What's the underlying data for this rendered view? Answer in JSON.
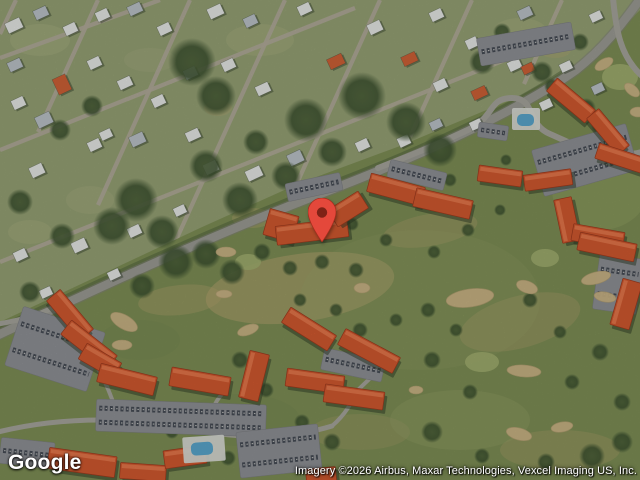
{
  "branding": {
    "logo": "Google"
  },
  "attribution": {
    "text": "Imagery ©2026 Airbus, Maxar Technologies, Vexcel Imaging US, Inc."
  },
  "marker": {
    "x": 322,
    "y": 242,
    "color": "#e4483b",
    "outline": "#a72d1d",
    "dot": "#7e2216"
  },
  "map": {
    "width": 640,
    "height": 480,
    "palette": {
      "golf_base": "#7e8f56",
      "golf_tan": "#b9a771",
      "golf_light": "#99a467",
      "golf_dark": "#6d814b",
      "bunker": "#cdb687",
      "green": "#a3b070",
      "res_base": "#96a275",
      "lawn": "#abb183",
      "street": "#b4ad9c",
      "road": "#9c9c95",
      "lane": "#a7a69d",
      "roof": "#d2592f",
      "roof_hi": "#ec8054",
      "roof_edge": "#9d3a1e",
      "house_w": "#e8eae7",
      "house_g": "#bcc4ca",
      "house_o": "#cf6136",
      "parking": "#8f9196",
      "car_dark": "#3f454e",
      "car_light": "#d8d8d4",
      "pool": "#5aa7cd",
      "deck": "#dadcd6",
      "tree": "#3d5230"
    },
    "residential": {
      "outline": "0,0 640,0 640,10 598,52 520,96 400,146 300,183 200,228 96,277 0,322",
      "patches": [
        [
          40,
          40,
          30,
          16,
          "lawn",
          0.45
        ],
        [
          260,
          40,
          34,
          16,
          "lawn",
          0.4
        ],
        [
          520,
          30,
          26,
          12,
          "lawn",
          0.4
        ],
        [
          90,
          200,
          24,
          14,
          "lawn",
          0.35
        ],
        [
          30,
          232,
          22,
          12,
          "lawn",
          0.4
        ],
        [
          150,
          60,
          26,
          12,
          "lawn",
          0.3
        ],
        [
          252,
          218,
          20,
          10,
          "tan",
          0.35
        ],
        [
          218,
          108,
          14,
          8,
          "tan",
          0.3
        ],
        [
          555,
          50,
          16,
          8,
          "tan",
          0.3
        ]
      ],
      "streets": [
        [
          0,
          58,
          160,
          0
        ],
        [
          0,
          150,
          355,
          8
        ],
        [
          0,
          262,
          540,
          46
        ],
        [
          16,
          0,
          0,
          34
        ],
        [
          98,
          0,
          38,
          132
        ],
        [
          190,
          0,
          98,
          205
        ],
        [
          285,
          0,
          172,
          249
        ],
        [
          380,
          0,
          293,
          192
        ],
        [
          472,
          0,
          410,
          137
        ],
        [
          562,
          0,
          524,
          84
        ]
      ],
      "house_rotation": -25,
      "houses": [
        [
          6,
          20,
          16,
          11,
          "w"
        ],
        [
          34,
          8,
          14,
          10,
          "g"
        ],
        [
          64,
          24,
          13,
          10,
          "w"
        ],
        [
          96,
          10,
          13,
          10,
          "w"
        ],
        [
          128,
          4,
          14,
          10,
          "g"
        ],
        [
          158,
          24,
          13,
          10,
          "w"
        ],
        [
          208,
          6,
          15,
          11,
          "w"
        ],
        [
          244,
          16,
          13,
          10,
          "g"
        ],
        [
          298,
          4,
          13,
          10,
          "w"
        ],
        [
          368,
          22,
          14,
          11,
          "w"
        ],
        [
          430,
          10,
          13,
          10,
          "w"
        ],
        [
          466,
          38,
          12,
          10,
          "w"
        ],
        [
          518,
          8,
          14,
          10,
          "g"
        ],
        [
          554,
          28,
          13,
          10,
          "w"
        ],
        [
          590,
          12,
          12,
          9,
          "w"
        ],
        [
          8,
          60,
          14,
          10,
          "g"
        ],
        [
          55,
          76,
          14,
          17,
          "o"
        ],
        [
          88,
          58,
          13,
          10,
          "w"
        ],
        [
          118,
          78,
          14,
          10,
          "w"
        ],
        [
          152,
          96,
          13,
          10,
          "w"
        ],
        [
          184,
          68,
          13,
          10,
          "g"
        ],
        [
          222,
          60,
          13,
          10,
          "w"
        ],
        [
          256,
          84,
          14,
          10,
          "w"
        ],
        [
          328,
          56,
          16,
          11,
          "o"
        ],
        [
          402,
          54,
          15,
          10,
          "o"
        ],
        [
          434,
          80,
          13,
          10,
          "w"
        ],
        [
          472,
          88,
          15,
          10,
          "o"
        ],
        [
          508,
          60,
          13,
          10,
          "w"
        ],
        [
          522,
          64,
          12,
          9,
          "o"
        ],
        [
          560,
          62,
          12,
          9,
          "w"
        ],
        [
          592,
          84,
          12,
          9,
          "g"
        ],
        [
          12,
          98,
          13,
          10,
          "w"
        ],
        [
          36,
          114,
          16,
          12,
          "g"
        ],
        [
          88,
          140,
          13,
          10,
          "w"
        ],
        [
          130,
          134,
          15,
          11,
          "g"
        ],
        [
          100,
          130,
          12,
          9,
          "w"
        ],
        [
          186,
          130,
          14,
          10,
          "w"
        ],
        [
          204,
          162,
          14,
          11,
          "w"
        ],
        [
          246,
          168,
          16,
          11,
          "w"
        ],
        [
          288,
          152,
          15,
          12,
          "g"
        ],
        [
          320,
          180,
          13,
          10,
          "w"
        ],
        [
          356,
          140,
          13,
          10,
          "w"
        ],
        [
          398,
          136,
          12,
          10,
          "w"
        ],
        [
          430,
          120,
          12,
          9,
          "g"
        ],
        [
          470,
          120,
          12,
          9,
          "w"
        ],
        [
          540,
          100,
          12,
          9,
          "w"
        ],
        [
          30,
          165,
          14,
          11,
          "w"
        ],
        [
          14,
          250,
          13,
          10,
          "w"
        ],
        [
          72,
          240,
          15,
          11,
          "w"
        ],
        [
          128,
          226,
          13,
          10,
          "w"
        ],
        [
          174,
          206,
          12,
          9,
          "w"
        ],
        [
          108,
          270,
          12,
          9,
          "w"
        ],
        [
          40,
          288,
          12,
          9,
          "w"
        ]
      ]
    },
    "golf": {
      "patches": [
        [
          300,
          288,
          95,
          34,
          -8,
          "tan",
          0.5
        ],
        [
          520,
          322,
          62,
          26,
          -15,
          "tan",
          0.3
        ],
        [
          430,
          230,
          48,
          16,
          -10,
          "tan",
          0.3
        ],
        [
          560,
          450,
          60,
          20,
          0,
          "tan",
          0.28
        ],
        [
          360,
          432,
          50,
          18,
          0,
          "tan",
          0.22
        ],
        [
          180,
          300,
          42,
          15,
          -6,
          "tan",
          0.35
        ],
        [
          460,
          420,
          70,
          30,
          0,
          "light",
          0.35
        ],
        [
          600,
          190,
          48,
          40,
          0,
          "light",
          0.4
        ],
        [
          420,
          300,
          120,
          70,
          0,
          "light",
          0.18
        ],
        [
          240,
          420,
          60,
          26,
          0,
          "dark",
          0.15
        ],
        [
          140,
          340,
          40,
          20,
          0,
          "dark",
          0.12
        ]
      ],
      "greens": [
        [
          620,
          77,
          18,
          13
        ],
        [
          482,
          362,
          17,
          10
        ],
        [
          545,
          258,
          14,
          9
        ],
        [
          248,
          262,
          13,
          8
        ]
      ],
      "bunkers": [
        [
          470,
          298,
          24,
          9,
          -8
        ],
        [
          362,
          288,
          8,
          5,
          0
        ],
        [
          527,
          287,
          11,
          6,
          20
        ],
        [
          596,
          278,
          15,
          6,
          -14
        ],
        [
          605,
          297,
          11,
          5,
          10
        ],
        [
          524,
          371,
          17,
          6,
          4
        ],
        [
          562,
          427,
          11,
          5,
          -10
        ],
        [
          519,
          434,
          13,
          6,
          15
        ],
        [
          124,
          322,
          15,
          7,
          30
        ],
        [
          122,
          345,
          10,
          5,
          0
        ],
        [
          248,
          330,
          11,
          5,
          -20
        ],
        [
          226,
          252,
          10,
          5,
          0
        ],
        [
          604,
          64,
          10,
          5,
          -30
        ],
        [
          632,
          90,
          9,
          5,
          40
        ],
        [
          416,
          390,
          7,
          4,
          0
        ],
        [
          638,
          112,
          8,
          5,
          0
        ],
        [
          224,
          294,
          8,
          4,
          0
        ]
      ]
    },
    "tree_line": "M -4,330 C 90,286 200,234 320,188 C 420,151 520,104 574,65",
    "trees": [
      [
        192,
        62,
        24
      ],
      [
        216,
        96,
        20
      ],
      [
        306,
        120,
        22
      ],
      [
        362,
        96,
        24
      ],
      [
        406,
        122,
        20
      ],
      [
        440,
        150,
        17
      ],
      [
        332,
        152,
        15
      ],
      [
        136,
        200,
        22
      ],
      [
        162,
        232,
        17
      ],
      [
        112,
        226,
        19
      ],
      [
        256,
        142,
        13
      ],
      [
        286,
        176,
        15
      ],
      [
        206,
        166,
        17
      ],
      [
        240,
        200,
        18
      ],
      [
        60,
        130,
        11
      ],
      [
        92,
        106,
        11
      ],
      [
        20,
        202,
        13
      ],
      [
        62,
        236,
        13
      ],
      [
        30,
        292,
        11
      ],
      [
        142,
        286,
        13
      ],
      [
        482,
        62,
        13
      ],
      [
        542,
        72,
        11
      ],
      [
        502,
        32,
        9
      ],
      [
        580,
        42,
        9
      ],
      [
        176,
        262,
        18
      ],
      [
        206,
        254,
        15
      ],
      [
        232,
        272,
        13
      ],
      [
        586,
        108,
        10
      ],
      [
        600,
        126,
        9
      ],
      [
        262,
        252,
        9
      ],
      [
        290,
        268,
        8
      ],
      [
        322,
        262,
        8
      ],
      [
        356,
        270,
        8
      ],
      [
        240,
        360,
        9
      ],
      [
        266,
        390,
        8
      ],
      [
        300,
        300,
        7
      ],
      [
        336,
        310,
        7
      ],
      [
        360,
        330,
        8
      ],
      [
        396,
        320,
        7
      ],
      [
        428,
        310,
        8
      ],
      [
        456,
        330,
        7
      ],
      [
        432,
        360,
        9
      ],
      [
        470,
        392,
        8
      ],
      [
        432,
        432,
        11
      ],
      [
        332,
        442,
        9
      ],
      [
        302,
        422,
        8
      ],
      [
        530,
        300,
        8
      ],
      [
        560,
        332,
        7
      ],
      [
        600,
        352,
        9
      ],
      [
        572,
        382,
        8
      ],
      [
        622,
        402,
        9
      ],
      [
        592,
        456,
        13
      ],
      [
        622,
        442,
        11
      ],
      [
        546,
        462,
        9
      ],
      [
        482,
        456,
        8
      ],
      [
        434,
        252,
        7
      ],
      [
        468,
        230,
        7
      ],
      [
        500,
        210,
        6
      ],
      [
        386,
        240,
        7
      ],
      [
        228,
        458,
        8
      ],
      [
        172,
        432,
        7
      ],
      [
        352,
        224,
        7
      ],
      [
        450,
        180,
        7
      ],
      [
        506,
        160,
        6
      ],
      [
        552,
        86,
        8
      ]
    ],
    "roads": [
      {
        "d": "M -4,336 C 90,292 200,240 320,194 C 420,156 520,110 576,70 C 604,48 622,24 638,2",
        "w": 8.5,
        "c": "road",
        "casing": true
      },
      {
        "d": "M 378,168 C 430,148 446,140 468,130 C 496,116 488,98 512,98 C 536,98 526,124 550,134 C 578,146 602,162 642,152",
        "w": 6,
        "c": "lane"
      },
      {
        "d": "M 613,-2 C 616,30 620,56 642,76",
        "w": 6,
        "c": "lane"
      },
      {
        "d": "M -2,432 C 70,414 150,418 210,432 C 250,440 300,436 332,426",
        "w": 5,
        "c": "lane"
      },
      {
        "d": "M 62,303 C 44,314 22,320 -2,324",
        "w": 5,
        "c": "lane"
      },
      {
        "d": "M 118,418 C 112,396 104,378 94,362",
        "w": 4,
        "c": "lane"
      },
      {
        "d": "M 210,432 C 208,416 214,402 224,392",
        "w": 4,
        "c": "lane"
      },
      {
        "d": "M 332,426 C 346,414 352,402 356,392 C 368,380 376,372 388,366",
        "w": 4,
        "c": "lane"
      }
    ],
    "parking": [
      [
        478,
        30,
        96,
        28,
        -10
      ],
      [
        478,
        124,
        30,
        15,
        8
      ],
      [
        536,
        136,
        98,
        48,
        -16
      ],
      [
        286,
        178,
        56,
        18,
        -12
      ],
      [
        388,
        166,
        58,
        18,
        14
      ],
      [
        12,
        318,
        86,
        62,
        18
      ],
      [
        96,
        402,
        170,
        32,
        2
      ],
      [
        238,
        428,
        82,
        46,
        -6
      ],
      [
        0,
        440,
        54,
        26,
        6
      ],
      [
        596,
        256,
        44,
        56,
        8
      ],
      [
        322,
        354,
        62,
        22,
        12
      ]
    ],
    "condos": [
      [
        546,
        92,
        50,
        17,
        40
      ],
      [
        584,
        124,
        48,
        16,
        50
      ],
      [
        596,
        150,
        48,
        16,
        18
      ],
      [
        478,
        168,
        44,
        16,
        8
      ],
      [
        524,
        172,
        48,
        16,
        -8
      ],
      [
        558,
        198,
        18,
        44,
        -12
      ],
      [
        572,
        228,
        52,
        17,
        10
      ],
      [
        266,
        212,
        30,
        27,
        16
      ],
      [
        276,
        222,
        72,
        19,
        -7
      ],
      [
        330,
        199,
        36,
        20,
        -32
      ],
      [
        368,
        180,
        56,
        19,
        15
      ],
      [
        414,
        194,
        58,
        19,
        13
      ],
      [
        44,
        306,
        52,
        18,
        50
      ],
      [
        60,
        336,
        58,
        18,
        38
      ],
      [
        80,
        352,
        40,
        18,
        30
      ],
      [
        98,
        370,
        58,
        19,
        14
      ],
      [
        170,
        372,
        60,
        19,
        10
      ],
      [
        244,
        352,
        20,
        48,
        14
      ],
      [
        48,
        452,
        68,
        21,
        8
      ],
      [
        120,
        464,
        46,
        16,
        4
      ],
      [
        164,
        448,
        42,
        18,
        -8
      ],
      [
        306,
        468,
        30,
        14,
        -6
      ],
      [
        282,
        320,
        54,
        18,
        32
      ],
      [
        338,
        342,
        62,
        18,
        28
      ],
      [
        286,
        372,
        58,
        18,
        8
      ],
      [
        324,
        388,
        60,
        18,
        8
      ],
      [
        578,
        238,
        58,
        18,
        12
      ],
      [
        616,
        280,
        20,
        48,
        16
      ]
    ],
    "pools": [
      {
        "deck": [
          512,
          108,
          28,
          22,
          0
        ],
        "water": [
          517,
          114,
          17,
          12
        ]
      },
      {
        "deck": [
          183,
          436,
          42,
          26,
          -4
        ],
        "water": [
          191,
          442,
          22,
          13
        ]
      }
    ]
  }
}
